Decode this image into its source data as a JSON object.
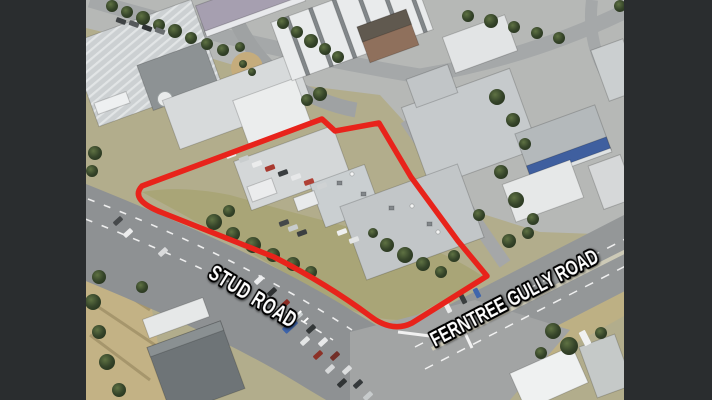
{
  "scene": {
    "background_color": "#2a2d2f"
  },
  "road_labels": {
    "stud": "STUD ROAD",
    "ferntree": "FERNTREE GULLY ROAD"
  },
  "annotation": {
    "boundary_path": "M 142 186 L 322 119 L 335 131 L 379 123 L 411 177 L 458 241 L 487 276 L 412 323 Q 392 333 370 316 Q 327 284 274 257 L 163 213 Q 129 200 142 186 Z",
    "boundary_color": "#e8231b",
    "label_fill": "#ffffff",
    "label_outline": "#000000"
  }
}
